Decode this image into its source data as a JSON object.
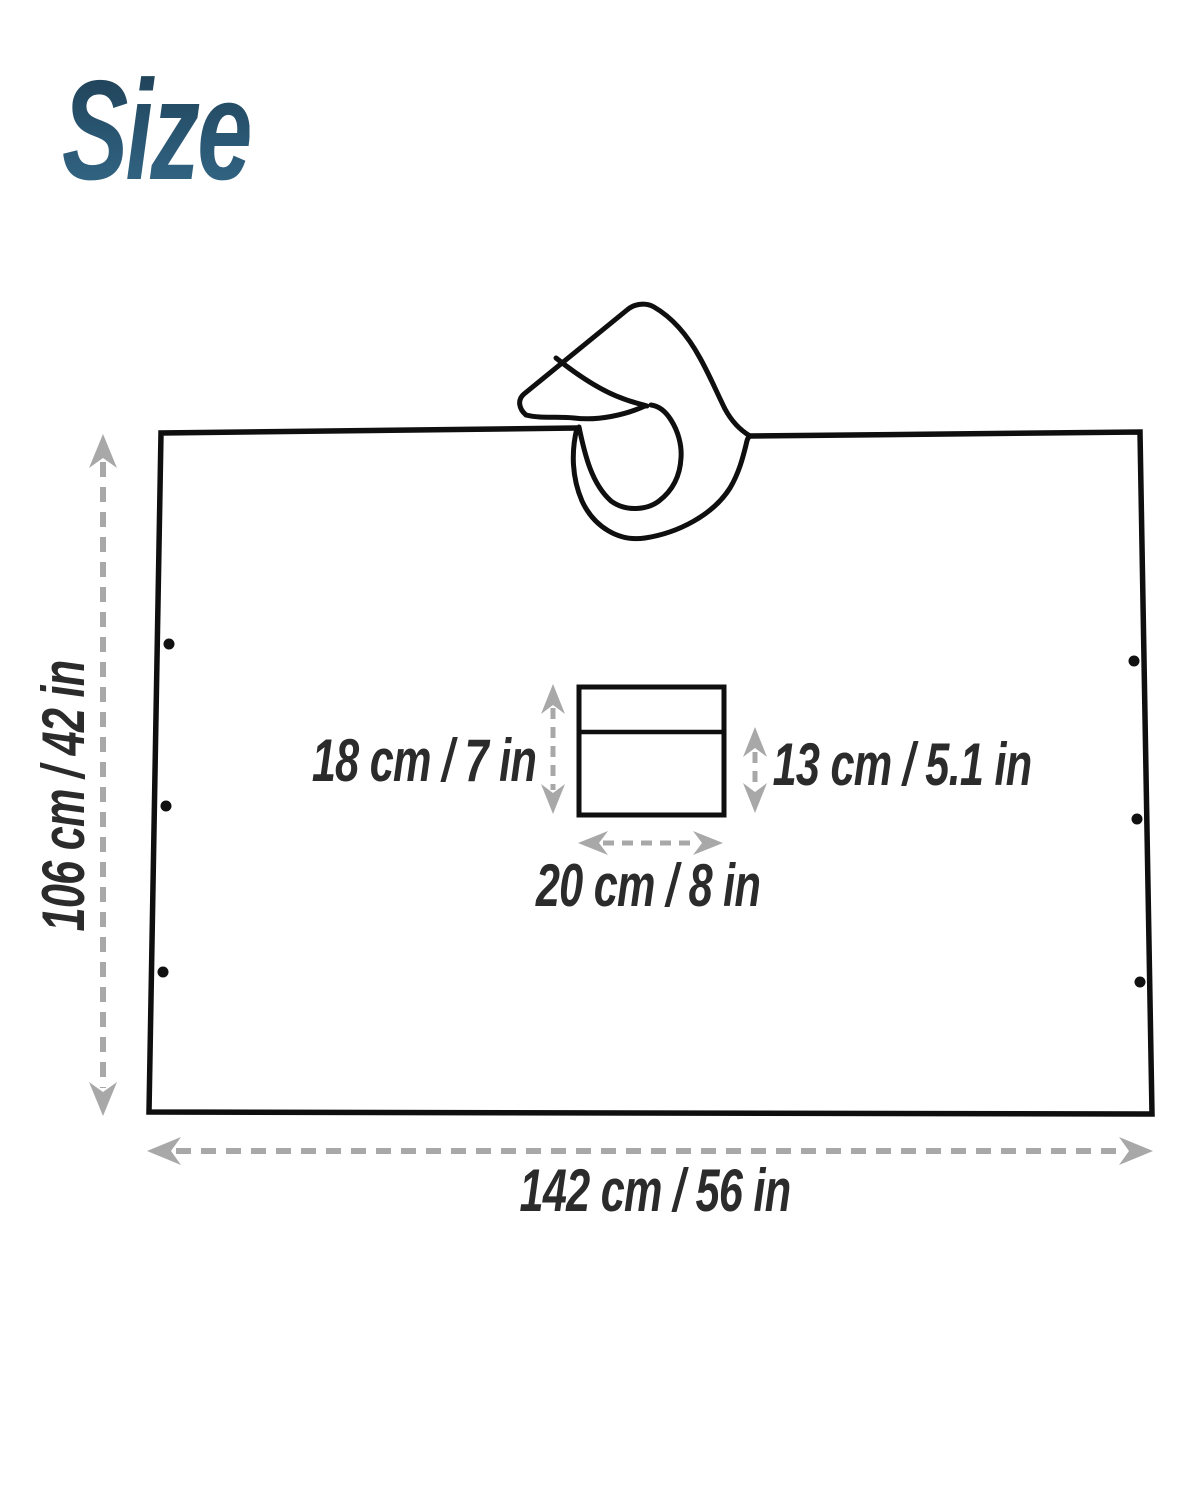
{
  "title": {
    "text": "Size",
    "color_top": "#1e3e53",
    "color_bottom": "#346988"
  },
  "diagram": {
    "poncho": {
      "height_label": "106 cm / 42 in",
      "width_label": "142 cm / 56 in",
      "snap_dots_per_side": 3
    },
    "pocket": {
      "height_label": "18 cm / 7 in",
      "lower_height_label": "13 cm / 5.1 in",
      "width_label": "20 cm / 8 in"
    },
    "colors": {
      "outline": "#0f0f0f",
      "arrow_gray": "#a8a8a8",
      "label_text": "#2b2b2b",
      "background": "#ffffff"
    }
  }
}
